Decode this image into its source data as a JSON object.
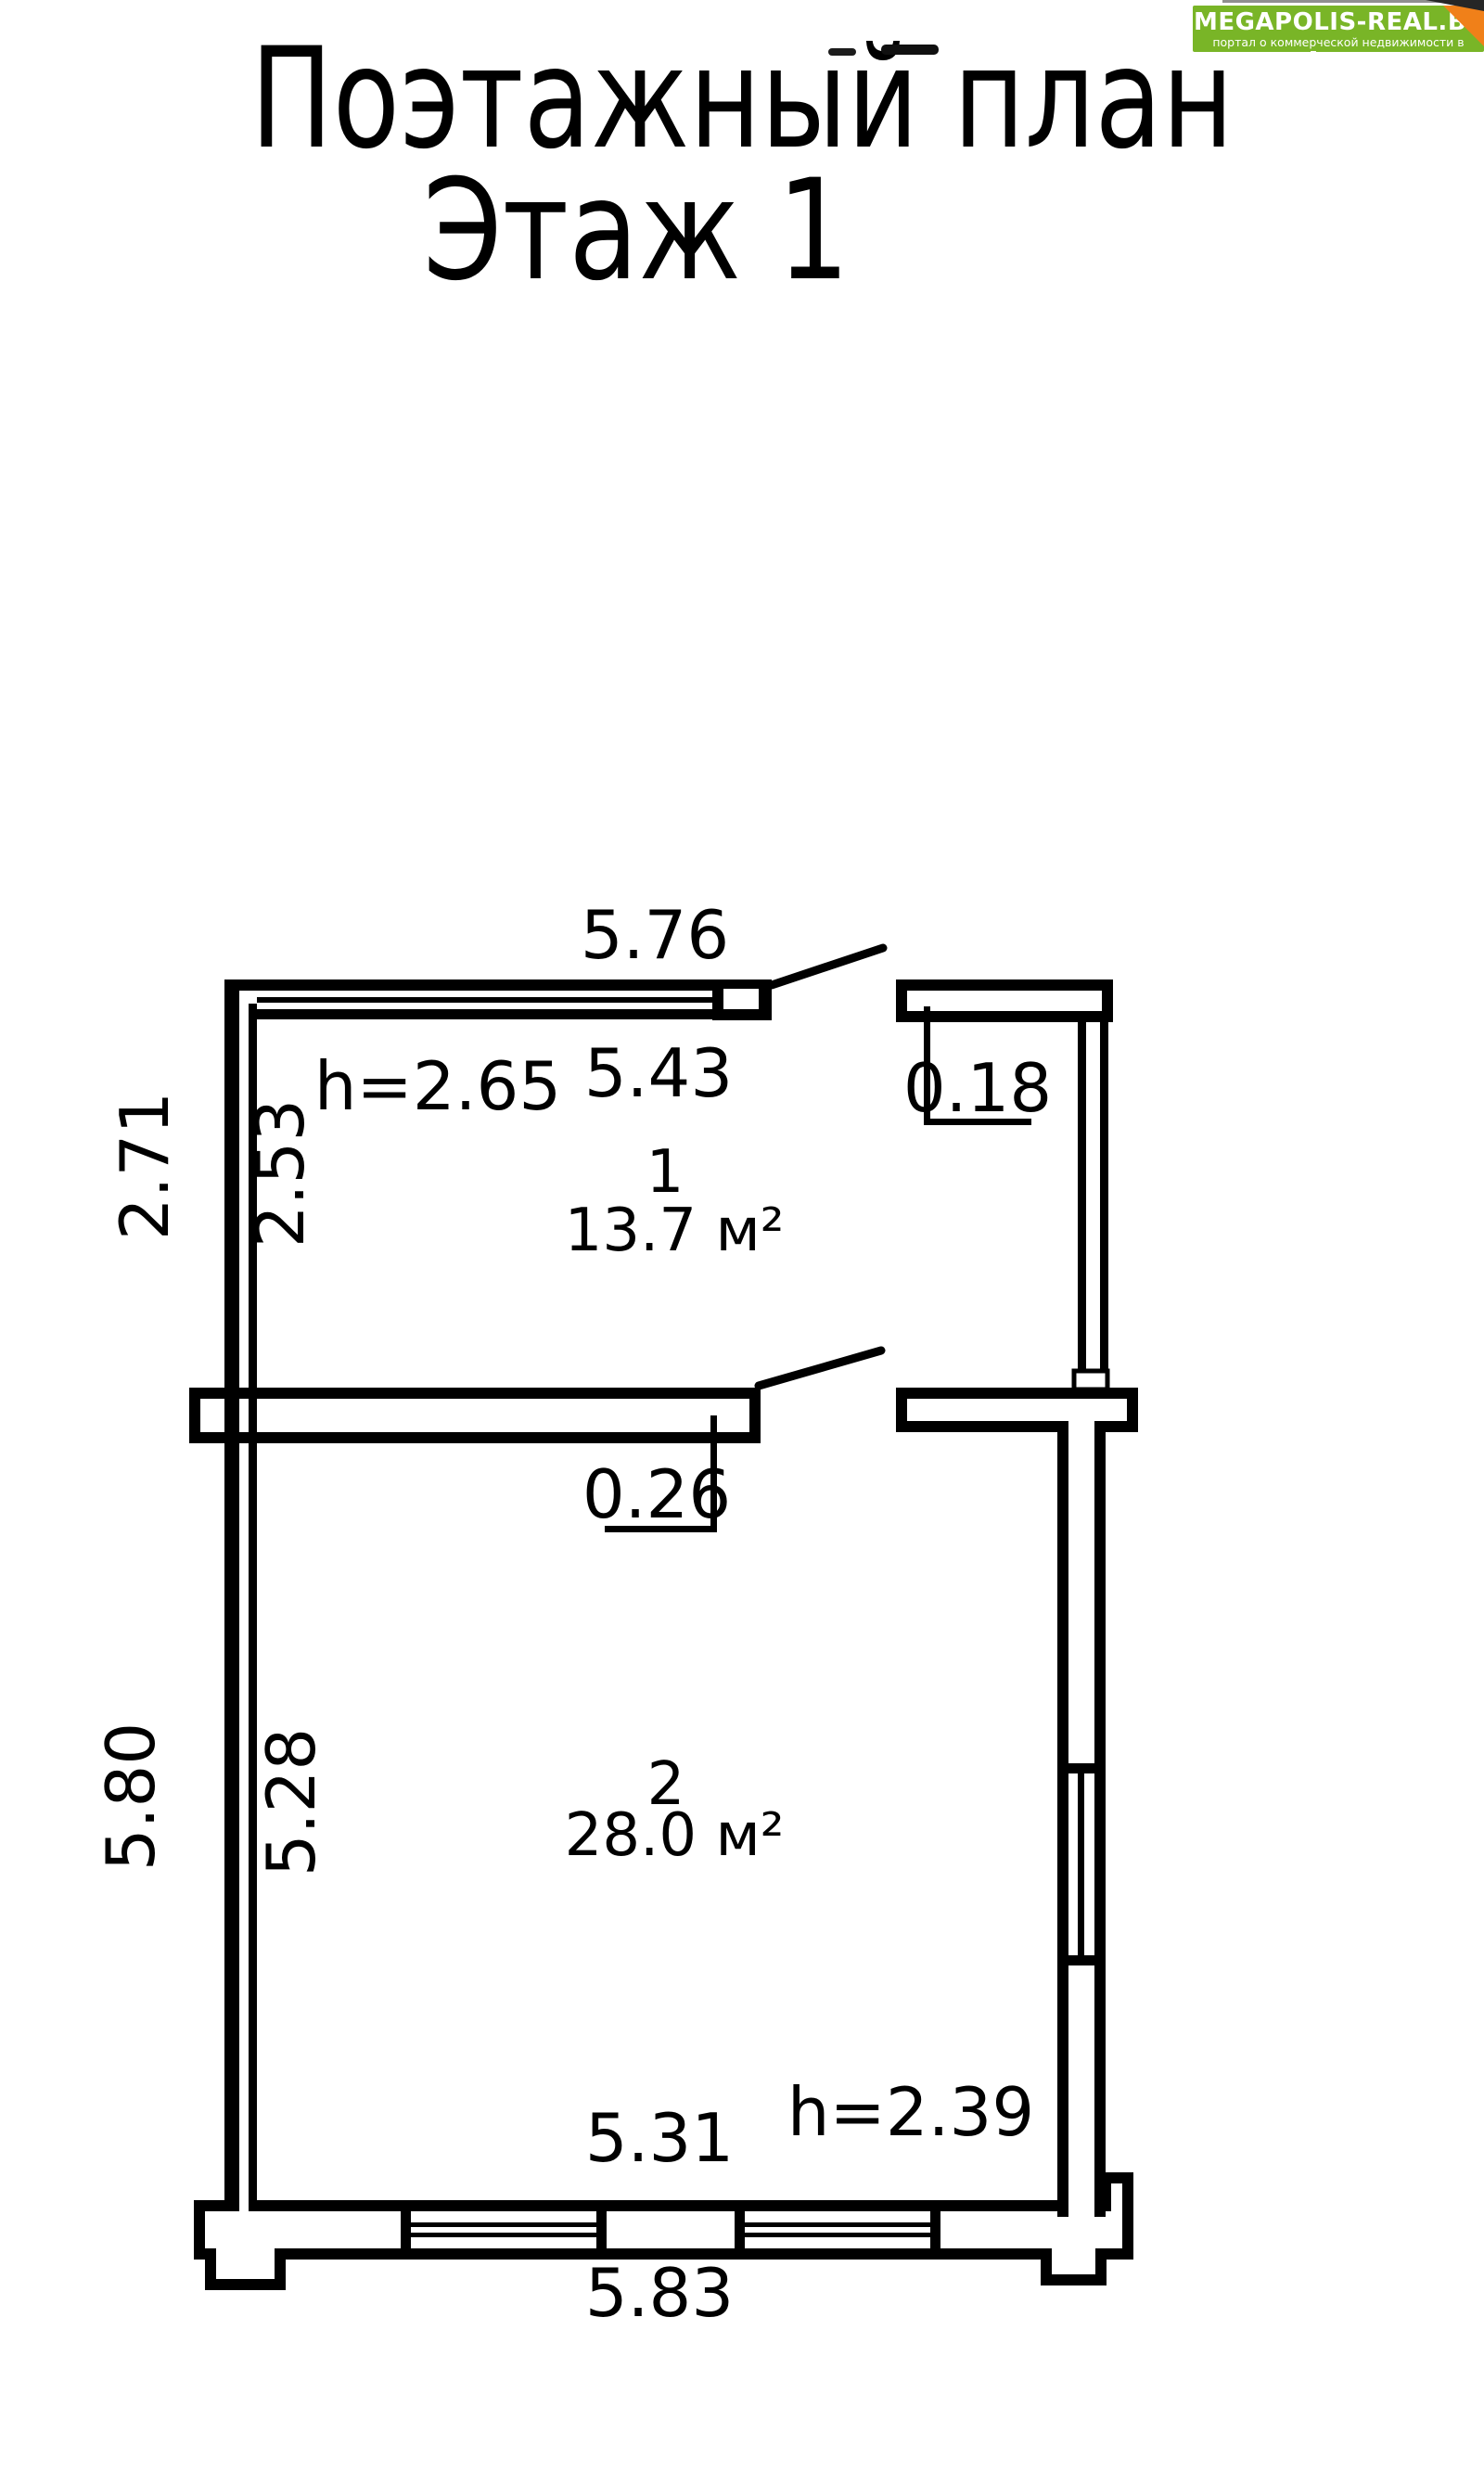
{
  "title": {
    "line1": "Поэтажный план",
    "line2": "Этаж 1"
  },
  "logo": {
    "name": "MEGAPOLIS-REAL.BY",
    "tagline": "портал о коммерческой недвижимости в Беларуси",
    "bg_color": "#79b527",
    "corner_color": "#f08019",
    "text_color": "#ffffff"
  },
  "plan": {
    "ink_color": "#000000",
    "rooms": [
      {
        "number": "1",
        "area": "13.7 м²",
        "ceiling_height": "h=2.65",
        "top_width_outer": "5.76",
        "width_inner": "5.43",
        "depth_outer": "2.71",
        "depth_inner": "2.53",
        "right_wall_thickness": "0.18"
      },
      {
        "number": "2",
        "area": "28.0 м²",
        "ceiling_height": "h=2.39",
        "top_wall_thickness": "0.26",
        "depth_outer": "5.80",
        "depth_inner": "5.28",
        "width_inner": "5.31",
        "bottom_width_outer": "5.83"
      }
    ]
  }
}
